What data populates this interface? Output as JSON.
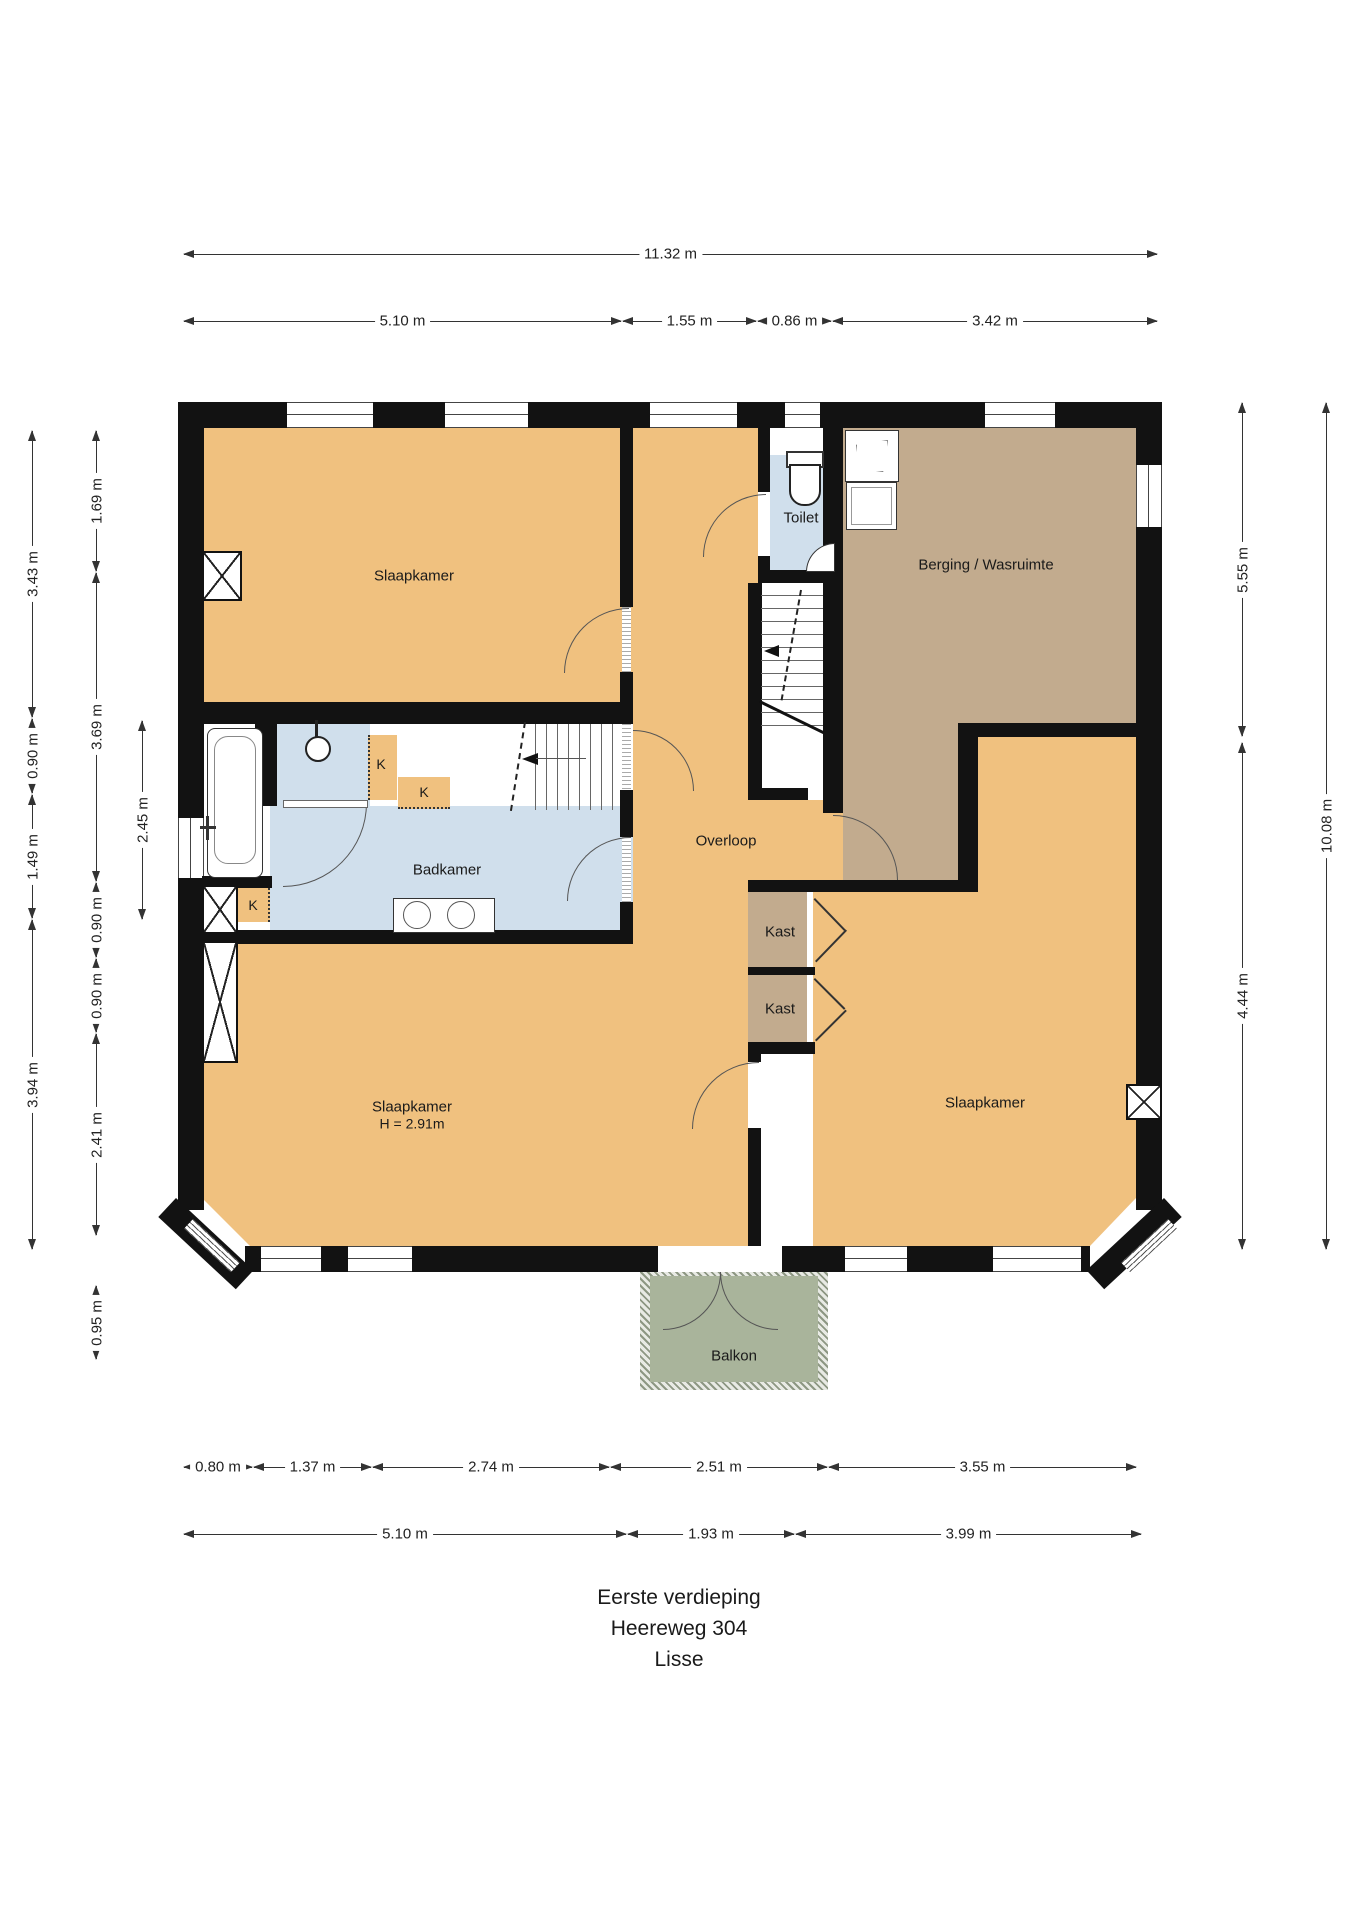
{
  "plan": {
    "title_lines": [
      "Eerste verdieping",
      "Heereweg 304",
      "Lisse"
    ],
    "rooms": {
      "slaapkamer_tl": "Slaapkamer",
      "toilet": "Toilet",
      "berging": "Berging / Wasruimte",
      "overloop": "Overloop",
      "badkamer": "Badkamer",
      "kast1": "Kast",
      "kast2": "Kast",
      "slaapkamer_bl_name": "Slaapkamer",
      "slaapkamer_bl_height": "H = 2.91m",
      "slaapkamer_br": "Slaapkamer",
      "balkon": "Balkon",
      "k1": "K",
      "k2": "K",
      "k3": "K"
    },
    "dimensions": {
      "top_total": "11.32 m",
      "top_segments": [
        "5.10 m",
        "1.55 m",
        "0.86 m",
        "3.42 m"
      ],
      "bottom_row1": [
        "0.80 m",
        "1.37 m",
        "2.74 m",
        "2.51 m",
        "3.55 m"
      ],
      "bottom_row2": [
        "5.10 m",
        "1.93 m",
        "3.99 m"
      ],
      "left_outer": [
        "3.43 m",
        "0.90 m",
        "1.49 m",
        "3.94 m"
      ],
      "left_middle": [
        "1.69 m",
        "3.69 m",
        "0.90 m",
        "0.90 m",
        "2.41 m",
        "0.95 m"
      ],
      "left_inner": [
        "2.45 m"
      ],
      "right_inner": [
        "5.55 m",
        "4.44 m"
      ],
      "right_outer": [
        "10.08 m"
      ]
    },
    "colors": {
      "floor_orange": "#f0c17f",
      "floor_tan": "#c2ab8e",
      "floor_blue": "#d0dfec",
      "balkon_green": "#a9b49b",
      "wall": "#121212"
    }
  }
}
